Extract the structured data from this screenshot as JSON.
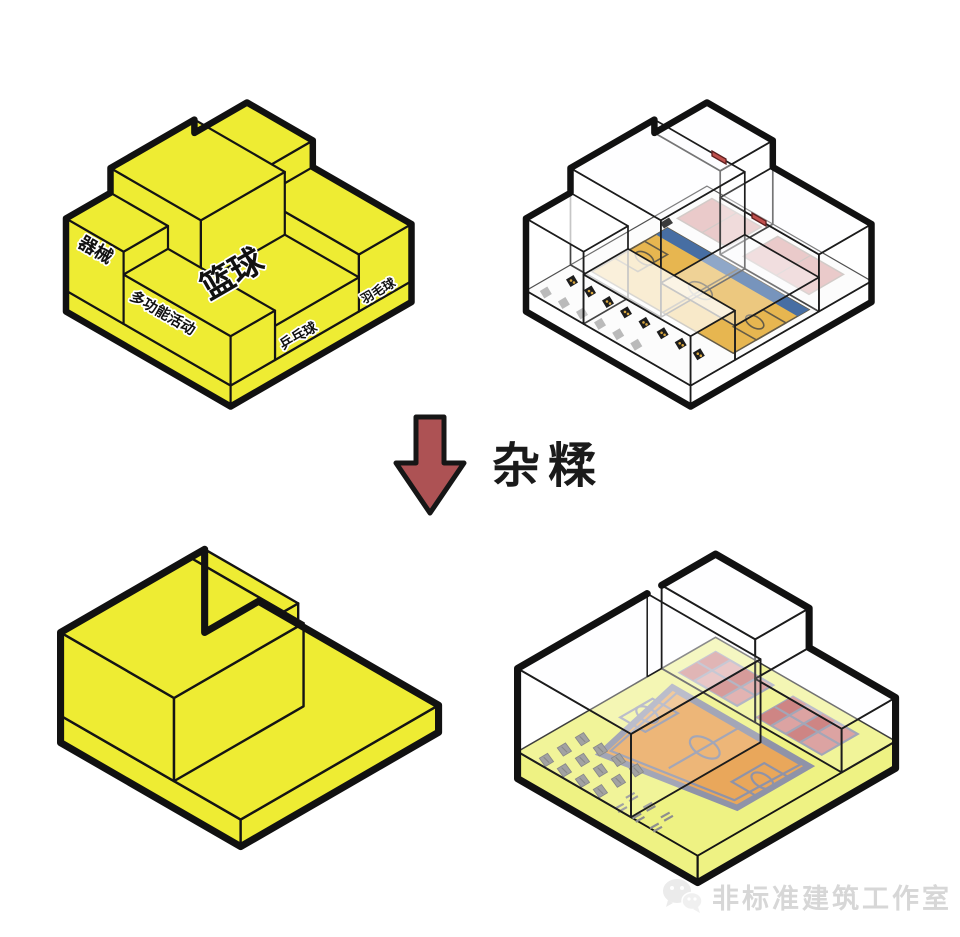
{
  "page": {
    "background": "#ffffff"
  },
  "colors": {
    "massing_yellow": "#eeec33",
    "outline_black": "#141414",
    "arrow_red": "#ad5254",
    "court_gold": "#e2a62a",
    "court_blue": "#1f4f8f",
    "court_line_dark": "#43381f",
    "plan_court_orange": "#e9a75b",
    "plan_line_gray": "#8f93a8",
    "pink_court": "#d58f8e",
    "pink_cell_red": "#c46b6a",
    "floor_yellow": "#eef283",
    "equipment_black": "#1d1d1d",
    "equipment_gray": "#8e8e8e",
    "equipment_dot_gold": "#d8a63e",
    "red_box": "#c0504d",
    "glass_edge": "#1c1c1c",
    "watermark_gray": "#d7d7d7"
  },
  "massing_labels": {
    "equipment": "器械",
    "multi_function": "多功能活动",
    "table_tennis": "乒乓球",
    "basketball": "篮球",
    "badminton": "羽毛球"
  },
  "operation": {
    "arrow_label": "杂糅"
  },
  "watermark": {
    "studio_name": "非标准建筑工作室",
    "icon": "wechat-chat-bubbles-icon"
  }
}
